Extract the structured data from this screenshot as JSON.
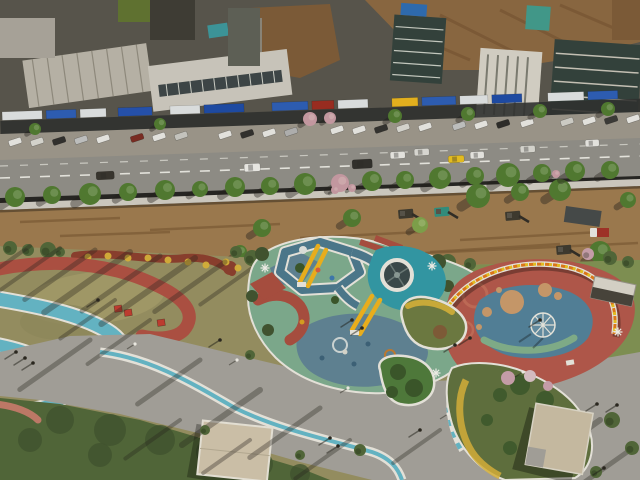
{
  "meta": {
    "description": "Aerial drone photograph: colorful riverside park with playground beside a commercial street, construction strip with excavators between them",
    "width": 640,
    "height": 480
  },
  "palette": {
    "building_base": "#56544d",
    "roof_light": "#b9b5ab",
    "roof_white": "#ccc9c1",
    "roof_bright": "#d5d2ca",
    "glass_dark": "#30403d",
    "glass_mid": "#5c5f58",
    "roof_green": "#5e7231",
    "roof_teal": "#39969e",
    "roof_teal2": "#3f9a8e",
    "roof_blue": "#2b6bb5",
    "dirt_hill": "#8a6742",
    "dirt_dark": "#6d4c2c",
    "brick_brown": "#7c5a38",
    "storefront": "#2c2f30",
    "sidewalk": "#9b968d",
    "road": "#8f8e89",
    "lane": "#e8e8e4",
    "wall": "#cfccc5",
    "dirt": "#9c7a50",
    "dirt_streak": "#7b5a36",
    "tree_green": "#4e7a31",
    "tree_light": "#7da24b",
    "tree_pink": "#c79aa6",
    "park_base": "#958f62",
    "lawn_dry": "#a29a6a",
    "lawn_green": "#7e9154",
    "shrub_dark": "#4e6639",
    "shrub_deep": "#3e5230",
    "track_red": "#ad4f43",
    "path_teal": "#63b7ca",
    "rim_white": "#e9e7e1",
    "plaza": "#a3a19c",
    "pad_green": "#7cab90",
    "pad_slate": "#5d8296",
    "walk_slate": "#49788f",
    "tower_teal": "#2f98a8",
    "slide_yellow": "#efb11c",
    "play_red": "#a84c40",
    "right_red": "#b1564b",
    "right_blue": "#50809b",
    "sand_tan": "#c9996c",
    "arc_green": "#7fae8c",
    "wall_orange": "#e07818",
    "wall_yellow": "#e8c020",
    "island_green": "#4c7a3c",
    "island_deep": "#37552a",
    "flower_yellow": "#d8b23a",
    "flower_red": "#8a3d2e",
    "roof_tan": "#cfc3ad",
    "roof_tan2": "#c9bda6",
    "cube_red": "#c03a30",
    "shadow": "rgba(35,32,28,0.34)"
  },
  "buildings": {
    "sign_strips": [
      {
        "x": 2,
        "w": 40,
        "c": "#dfe3e6"
      },
      {
        "x": 46,
        "w": 30,
        "c": "#2a5cb8"
      },
      {
        "x": 80,
        "w": 26,
        "c": "#dfe3e6"
      },
      {
        "x": 118,
        "w": 34,
        "c": "#2150b0"
      },
      {
        "x": 170,
        "w": 30,
        "c": "#dfe3e6"
      },
      {
        "x": 204,
        "w": 40,
        "c": "#1a49a8"
      },
      {
        "x": 272,
        "w": 36,
        "c": "#2a5cb8"
      },
      {
        "x": 312,
        "w": 22,
        "c": "#9a2a20"
      },
      {
        "x": 338,
        "w": 30,
        "c": "#dfe3e6"
      },
      {
        "x": 392,
        "w": 26,
        "c": "#e8b41e"
      },
      {
        "x": 422,
        "w": 34,
        "c": "#2a5cb8"
      },
      {
        "x": 460,
        "w": 28,
        "c": "#dfe3e6"
      },
      {
        "x": 492,
        "w": 30,
        "c": "#1a49a8"
      },
      {
        "x": 548,
        "w": 36,
        "c": "#dfe3e6"
      },
      {
        "x": 588,
        "w": 30,
        "c": "#2a5cb8"
      }
    ]
  },
  "street": {
    "parked_cars": [
      {
        "x": 8,
        "y": 141,
        "c": "#e8e8e6"
      },
      {
        "x": 30,
        "y": 141,
        "c": "#d8d8d4"
      },
      {
        "x": 52,
        "y": 140,
        "c": "#2e2e2e"
      },
      {
        "x": 74,
        "y": 139,
        "c": "#c0c2c4"
      },
      {
        "x": 96,
        "y": 138,
        "c": "#e8e8e6"
      },
      {
        "x": 130,
        "y": 137,
        "c": "#7a2a22"
      },
      {
        "x": 152,
        "y": 136,
        "c": "#e8e8e6"
      },
      {
        "x": 174,
        "y": 135,
        "c": "#c8c8c4"
      },
      {
        "x": 218,
        "y": 134,
        "c": "#e8e8e6"
      },
      {
        "x": 240,
        "y": 133,
        "c": "#2e2e2e"
      },
      {
        "x": 262,
        "y": 132,
        "c": "#e8e8e6"
      },
      {
        "x": 284,
        "y": 131,
        "c": "#b0b2b4"
      },
      {
        "x": 330,
        "y": 129,
        "c": "#e8e8e6"
      },
      {
        "x": 352,
        "y": 129,
        "c": "#e8e8e6"
      },
      {
        "x": 374,
        "y": 128,
        "c": "#303030"
      },
      {
        "x": 396,
        "y": 127,
        "c": "#d8d8d4"
      },
      {
        "x": 418,
        "y": 126,
        "c": "#e8e8e6"
      },
      {
        "x": 452,
        "y": 125,
        "c": "#c0c2c4"
      },
      {
        "x": 474,
        "y": 124,
        "c": "#e8e8e6"
      },
      {
        "x": 496,
        "y": 123,
        "c": "#2a2a2a"
      },
      {
        "x": 520,
        "y": 122,
        "c": "#e8e8e6"
      },
      {
        "x": 560,
        "y": 121,
        "c": "#d0d0cc"
      },
      {
        "x": 582,
        "y": 120,
        "c": "#e8e8e6"
      },
      {
        "x": 604,
        "y": 119,
        "c": "#383838"
      },
      {
        "x": 626,
        "y": 118,
        "c": "#e8e8e6"
      }
    ],
    "vehicles": [
      {
        "x": 244,
        "y": 164,
        "w": 16,
        "h": 8,
        "c": "#ececea"
      },
      {
        "x": 352,
        "y": 160,
        "w": 20,
        "h": 9,
        "c": "#2e2e2c"
      },
      {
        "x": 390,
        "y": 152,
        "w": 15,
        "h": 7,
        "c": "#e8e8e6"
      },
      {
        "x": 414,
        "y": 149,
        "w": 15,
        "h": 7,
        "c": "#dcdcd8"
      },
      {
        "x": 448,
        "y": 156,
        "w": 16,
        "h": 7,
        "c": "#e8c020"
      },
      {
        "x": 470,
        "y": 152,
        "w": 14,
        "h": 7,
        "c": "#e8e8e6"
      },
      {
        "x": 520,
        "y": 146,
        "w": 15,
        "h": 7,
        "c": "#d8d8d4"
      },
      {
        "x": 96,
        "y": 172,
        "w": 18,
        "h": 8,
        "c": "#35332f"
      },
      {
        "x": 585,
        "y": 140,
        "w": 14,
        "h": 7,
        "c": "#e8e8e6"
      }
    ],
    "north_trees": [
      {
        "x": 35,
        "y": 129,
        "r": 6
      },
      {
        "x": 160,
        "y": 124,
        "r": 6
      },
      {
        "x": 310,
        "y": 119,
        "r": 7,
        "c": "pink"
      },
      {
        "x": 330,
        "y": 118,
        "r": 6,
        "c": "pink"
      },
      {
        "x": 395,
        "y": 116,
        "r": 7
      },
      {
        "x": 468,
        "y": 114,
        "r": 7
      },
      {
        "x": 540,
        "y": 111,
        "r": 7
      },
      {
        "x": 608,
        "y": 109,
        "r": 7
      }
    ],
    "south_trees": [
      {
        "x": 15,
        "y": 197,
        "r": 10
      },
      {
        "x": 52,
        "y": 195,
        "r": 9
      },
      {
        "x": 90,
        "y": 194,
        "r": 11
      },
      {
        "x": 128,
        "y": 192,
        "r": 9
      },
      {
        "x": 165,
        "y": 190,
        "r": 10
      },
      {
        "x": 200,
        "y": 189,
        "r": 8
      },
      {
        "x": 235,
        "y": 187,
        "r": 10
      },
      {
        "x": 270,
        "y": 186,
        "r": 9
      },
      {
        "x": 305,
        "y": 184,
        "r": 11
      },
      {
        "x": 340,
        "y": 183,
        "r": 9,
        "c": "pink"
      },
      {
        "x": 372,
        "y": 181,
        "r": 10
      },
      {
        "x": 405,
        "y": 180,
        "r": 9
      },
      {
        "x": 440,
        "y": 178,
        "r": 11
      },
      {
        "x": 475,
        "y": 176,
        "r": 9
      },
      {
        "x": 508,
        "y": 175,
        "r": 12
      },
      {
        "x": 542,
        "y": 173,
        "r": 9
      },
      {
        "x": 575,
        "y": 171,
        "r": 10
      },
      {
        "x": 610,
        "y": 170,
        "r": 9
      },
      {
        "x": 335,
        "y": 190,
        "r": 4,
        "c": "pink"
      },
      {
        "x": 352,
        "y": 188,
        "r": 4,
        "c": "pink"
      },
      {
        "x": 556,
        "y": 174,
        "r": 4,
        "c": "pink"
      }
    ]
  },
  "construction": {
    "dirt_streaks": [
      {
        "x1": 20,
        "y1": 222,
        "x2": 120,
        "y2": 218
      },
      {
        "x1": 150,
        "y1": 230,
        "x2": 280,
        "y2": 224
      },
      {
        "x1": 300,
        "y1": 238,
        "x2": 420,
        "y2": 232
      },
      {
        "x1": 430,
        "y1": 252,
        "x2": 560,
        "y2": 244
      },
      {
        "x1": 460,
        "y1": 240,
        "x2": 600,
        "y2": 232
      },
      {
        "x1": 60,
        "y1": 236,
        "x2": 170,
        "y2": 232
      },
      {
        "x1": 425,
        "y1": 253,
        "x2": 638,
        "y2": 243
      }
    ],
    "machines": [
      {
        "t": "tarp",
        "x": 566,
        "y": 206
      },
      {
        "t": "truckred",
        "x": 590,
        "y": 228
      },
      {
        "t": "exc",
        "x": 505,
        "y": 212
      },
      {
        "t": "exc",
        "x": 398,
        "y": 210
      },
      {
        "t": "loader",
        "x": 434,
        "y": 208
      },
      {
        "t": "excy",
        "x": 292,
        "y": 243
      },
      {
        "t": "exc",
        "x": 556,
        "y": 246
      }
    ],
    "trees": [
      {
        "x": 262,
        "y": 228,
        "r": 9
      },
      {
        "x": 300,
        "y": 246,
        "r": 7,
        "c": "light"
      },
      {
        "x": 352,
        "y": 218,
        "r": 9
      },
      {
        "x": 420,
        "y": 225,
        "r": 8,
        "c": "light"
      },
      {
        "x": 478,
        "y": 196,
        "r": 12
      },
      {
        "x": 520,
        "y": 192,
        "r": 9
      },
      {
        "x": 560,
        "y": 190,
        "r": 11
      },
      {
        "x": 600,
        "y": 252,
        "r": 11
      },
      {
        "x": 628,
        "y": 200,
        "r": 8
      },
      {
        "x": 240,
        "y": 252,
        "r": 7
      }
    ]
  },
  "park": {
    "bush_band": [
      {
        "x": 10,
        "y": 248,
        "r": 7
      },
      {
        "x": 28,
        "y": 250,
        "r": 6
      },
      {
        "x": 48,
        "y": 250,
        "r": 8
      },
      {
        "x": 60,
        "y": 252,
        "r": 5
      },
      {
        "x": 236,
        "y": 252,
        "r": 6
      },
      {
        "x": 252,
        "y": 258,
        "r": 8
      },
      {
        "x": 272,
        "y": 256,
        "r": 7
      },
      {
        "x": 296,
        "y": 252,
        "r": 6
      },
      {
        "x": 320,
        "y": 256,
        "r": 7
      },
      {
        "x": 344,
        "y": 258,
        "r": 6
      },
      {
        "x": 368,
        "y": 262,
        "r": 8
      },
      {
        "x": 392,
        "y": 260,
        "r": 6
      },
      {
        "x": 425,
        "y": 265,
        "r": 7
      },
      {
        "x": 448,
        "y": 262,
        "r": 8
      },
      {
        "x": 470,
        "y": 264,
        "r": 6
      },
      {
        "x": 610,
        "y": 258,
        "r": 7
      },
      {
        "x": 628,
        "y": 262,
        "r": 6
      },
      {
        "x": 588,
        "y": 254,
        "r": 6,
        "c": "#c9a0ae"
      }
    ],
    "flower_dots": [
      {
        "x": 88,
        "y": 257
      },
      {
        "x": 108,
        "y": 256
      },
      {
        "x": 128,
        "y": 258
      },
      {
        "x": 148,
        "y": 258
      },
      {
        "x": 168,
        "y": 260
      },
      {
        "x": 188,
        "y": 262
      },
      {
        "x": 206,
        "y": 265
      },
      {
        "x": 226,
        "y": 262
      },
      {
        "x": 238,
        "y": 268
      }
    ],
    "bench_cubes": [
      {
        "x": 114,
        "y": 306
      },
      {
        "x": 124,
        "y": 310
      },
      {
        "x": 157,
        "y": 320
      }
    ],
    "shadow_streaks": [
      {
        "x": 95,
        "y": 250,
        "len": 90,
        "w": 5
      },
      {
        "x": 130,
        "y": 252,
        "len": 110,
        "w": 6
      },
      {
        "x": 160,
        "y": 256,
        "len": 100,
        "w": 5
      },
      {
        "x": 195,
        "y": 258,
        "len": 120,
        "w": 6
      },
      {
        "x": 225,
        "y": 262,
        "len": 90,
        "w": 5
      },
      {
        "x": 255,
        "y": 266,
        "len": 70,
        "w": 4
      },
      {
        "x": 60,
        "y": 248,
        "len": 80,
        "w": 4
      },
      {
        "x": 30,
        "y": 246,
        "len": 70,
        "w": 4
      },
      {
        "x": 115,
        "y": 300,
        "len": 70,
        "w": 4
      },
      {
        "x": 150,
        "y": 320,
        "len": 80,
        "w": 4
      },
      {
        "x": 90,
        "y": 340,
        "len": 90,
        "w": 5
      },
      {
        "x": 200,
        "y": 360,
        "len": 80,
        "w": 5
      },
      {
        "x": 260,
        "y": 390,
        "len": 100,
        "w": 6
      },
      {
        "x": 320,
        "y": 408,
        "len": 90,
        "w": 5
      },
      {
        "x": 420,
        "y": 300,
        "len": 60,
        "w": 4
      },
      {
        "x": 470,
        "y": 300,
        "len": 50,
        "w": 3
      },
      {
        "x": 600,
        "y": 420,
        "len": 90,
        "w": 6
      },
      {
        "x": 630,
        "y": 450,
        "len": 80,
        "w": 5
      },
      {
        "x": 560,
        "y": 300,
        "len": 40,
        "w": 3
      },
      {
        "x": 350,
        "y": 440,
        "len": 70,
        "w": 4
      },
      {
        "x": 250,
        "y": 440,
        "len": 60,
        "w": 4
      },
      {
        "x": 180,
        "y": 420,
        "len": 70,
        "w": 4
      },
      {
        "x": 440,
        "y": 430,
        "len": 60,
        "w": 4
      }
    ],
    "plaza_bushes": [
      {
        "x": 250,
        "y": 355,
        "r": 5
      },
      {
        "x": 288,
        "y": 363,
        "r": 5
      },
      {
        "x": 430,
        "y": 380,
        "r": 6
      },
      {
        "x": 392,
        "y": 383,
        "r": 4
      },
      {
        "x": 360,
        "y": 450,
        "r": 6
      },
      {
        "x": 300,
        "y": 455,
        "r": 5
      },
      {
        "x": 612,
        "y": 420,
        "r": 8
      },
      {
        "x": 632,
        "y": 448,
        "r": 7
      },
      {
        "x": 596,
        "y": 472,
        "r": 6
      },
      {
        "x": 205,
        "y": 430,
        "r": 5
      }
    ],
    "people": [
      {
        "x": 16,
        "y": 352
      },
      {
        "x": 25,
        "y": 358
      },
      {
        "x": 33,
        "y": 363
      },
      {
        "x": 98,
        "y": 300
      },
      {
        "x": 220,
        "y": 340
      },
      {
        "x": 330,
        "y": 438
      },
      {
        "x": 338,
        "y": 446
      },
      {
        "x": 597,
        "y": 404
      },
      {
        "x": 617,
        "y": 405
      },
      {
        "x": 604,
        "y": 468
      },
      {
        "x": 420,
        "y": 430
      },
      {
        "x": 455,
        "y": 345
      },
      {
        "x": 352,
        "y": 320
      },
      {
        "x": 362,
        "y": 328
      },
      {
        "x": 540,
        "y": 320
      },
      {
        "x": 470,
        "y": 338
      }
    ],
    "lamps": [
      {
        "x": 237,
        "y": 360
      },
      {
        "x": 523,
        "y": 372
      },
      {
        "x": 348,
        "y": 388
      },
      {
        "x": 135,
        "y": 344
      },
      {
        "x": 448,
        "y": 414
      }
    ],
    "decor_stars": [
      {
        "x": 265,
        "y": 268
      },
      {
        "x": 432,
        "y": 266
      },
      {
        "x": 436,
        "y": 373
      },
      {
        "x": 618,
        "y": 332
      }
    ],
    "playground_dots": [
      {
        "x": 318,
        "y": 270,
        "c": "#d85a40"
      },
      {
        "x": 332,
        "y": 278,
        "c": "#3a78b0"
      },
      {
        "x": 302,
        "y": 322,
        "c": "#d8a020"
      },
      {
        "x": 345,
        "y": 352,
        "c": "#d8d8d0"
      },
      {
        "x": 368,
        "y": 344,
        "c": "#39607a"
      },
      {
        "x": 322,
        "y": 358,
        "c": "#39607a"
      },
      {
        "x": 354,
        "y": 364,
        "c": "#39607a"
      }
    ],
    "sand_circles": [
      {
        "x": 512,
        "y": 302,
        "r": 12
      },
      {
        "x": 545,
        "y": 290,
        "r": 7
      },
      {
        "x": 487,
        "y": 312,
        "r": 5
      },
      {
        "x": 479,
        "y": 327,
        "r": 3
      },
      {
        "x": 558,
        "y": 296,
        "r": 4
      },
      {
        "x": 499,
        "y": 290,
        "r": 3
      }
    ],
    "islandB_trees": [
      {
        "x": 398,
        "y": 372,
        "r": 8
      },
      {
        "x": 414,
        "y": 388,
        "r": 9
      },
      {
        "x": 392,
        "y": 392,
        "r": 6
      }
    ],
    "islandBR_bushes": [
      {
        "x": 520,
        "y": 385,
        "r": 10
      },
      {
        "x": 545,
        "y": 400,
        "r": 9
      },
      {
        "x": 500,
        "y": 395,
        "r": 7
      },
      {
        "x": 560,
        "y": 428,
        "r": 8
      },
      {
        "x": 487,
        "y": 420,
        "r": 6
      },
      {
        "x": 510,
        "y": 448,
        "r": 7
      }
    ],
    "islandBR_blossoms": [
      {
        "x": 508,
        "y": 378,
        "r": 7,
        "c": "#c9a0ae"
      },
      {
        "x": 530,
        "y": 376,
        "r": 6,
        "c": "#d8c0c8"
      },
      {
        "x": 548,
        "y": 386,
        "r": 5,
        "c": "#c9a0ae"
      }
    ],
    "shrub_blobs": [
      {
        "x": 60,
        "y": 420,
        "r": 14
      },
      {
        "x": 110,
        "y": 430,
        "r": 16
      },
      {
        "x": 160,
        "y": 440,
        "r": 15
      },
      {
        "x": 210,
        "y": 452,
        "r": 14
      },
      {
        "x": 260,
        "y": 464,
        "r": 13
      },
      {
        "x": 100,
        "y": 455,
        "r": 12
      },
      {
        "x": 30,
        "y": 440,
        "r": 12
      },
      {
        "x": 300,
        "y": 474,
        "r": 10
      }
    ]
  }
}
